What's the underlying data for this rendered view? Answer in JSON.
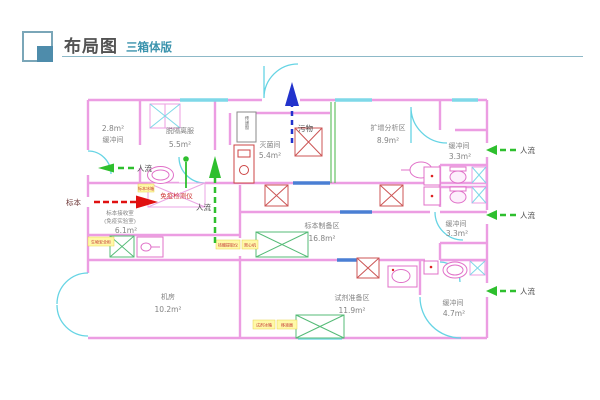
{
  "header": {
    "title": "布局图",
    "subtitle": "三箱体版"
  },
  "colors": {
    "accent_teal": "#3a93ad",
    "wall_pink": "#ec9de2",
    "door_cyan": "#66d4e4",
    "window_blue": "#4a7fd4",
    "flow_green": "#2ebf2e",
    "waste_blue": "#2233cc",
    "specimen_red": "#e01010",
    "equipment_green": "#55bb77",
    "label_yellow": "#fff9a8"
  },
  "plan": {
    "flows": {
      "people": "人流",
      "specimen": "标本",
      "waste": "污物"
    },
    "rooms": {
      "buffer_top_left": {
        "area": "2.8m²",
        "label": "缓冲间"
      },
      "undress": {
        "label": "脱隔离服",
        "area": "5.5m²"
      },
      "sterilization": {
        "label": "灭菌间",
        "area": "5.4m²"
      },
      "amplification": {
        "label": "扩增分析区",
        "area": "8.9m²"
      },
      "buffer_top_right": {
        "label": "缓冲间",
        "area": "3.3m²"
      },
      "specimen_receive": {
        "label": "标本接收室",
        "sublabel": "(免疫实验室)",
        "area": "6.1m²"
      },
      "specimen_prep": {
        "label": "标本制备区",
        "area": "16.8m²"
      },
      "buffer_mid_right": {
        "label": "缓冲间",
        "area": "3.3m²"
      },
      "machine_room": {
        "label": "机房",
        "area": "10.2m²"
      },
      "reagent_prep": {
        "label": "试剂准备区",
        "area": "11.9m²"
      },
      "buffer_bottom_right": {
        "label": "缓冲间",
        "area": "4.7m²"
      }
    },
    "equipment": {
      "immuno_analyzer": "免疫检测仪",
      "pass_window": "传递窗",
      "small_labels": [
        "生物安全柜",
        "标本冰箱",
        "核酸提取仪",
        "离心机",
        "试剂冰箱",
        "移液器"
      ]
    }
  }
}
